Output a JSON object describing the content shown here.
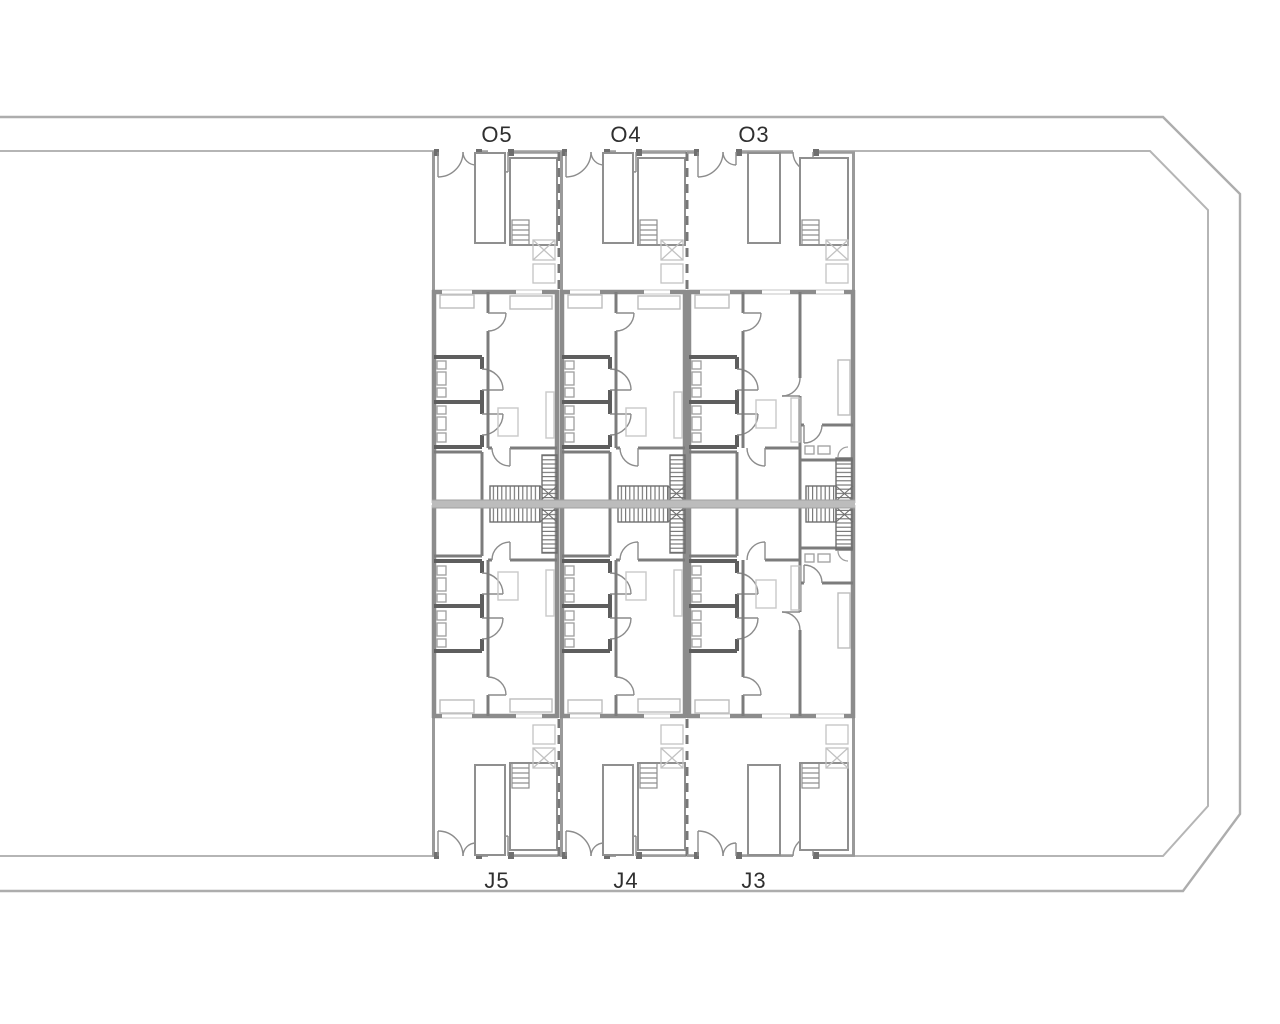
{
  "document": {
    "type": "architectural floor plan",
    "style": "grey line drawing on white, mirrored row houses between two streets"
  },
  "colors": {
    "background": "#ffffff",
    "boundary_line": "#adadad",
    "wall": "#8c8c8c",
    "wall_dark": "#5e5e5e",
    "thin_line": "#c6c6c6",
    "furniture": "#c9c9c9",
    "hatch": "#6e6e6e",
    "center_band": "#bcbcbc",
    "label_text": "#2f2f2f"
  },
  "units": {
    "top": [
      {
        "label": "O5"
      },
      {
        "label": "O4"
      },
      {
        "label": "O3"
      }
    ],
    "bottom": [
      {
        "label": "J5"
      },
      {
        "label": "J4"
      },
      {
        "label": "J3"
      }
    ]
  },
  "elements": {
    "door_swing": "quarter-circle arc",
    "stair_run": "hatched rectangle",
    "skylight": "square with X diagonals",
    "planter": "plain rectangle",
    "ladder": "small rectangle with rungs"
  }
}
